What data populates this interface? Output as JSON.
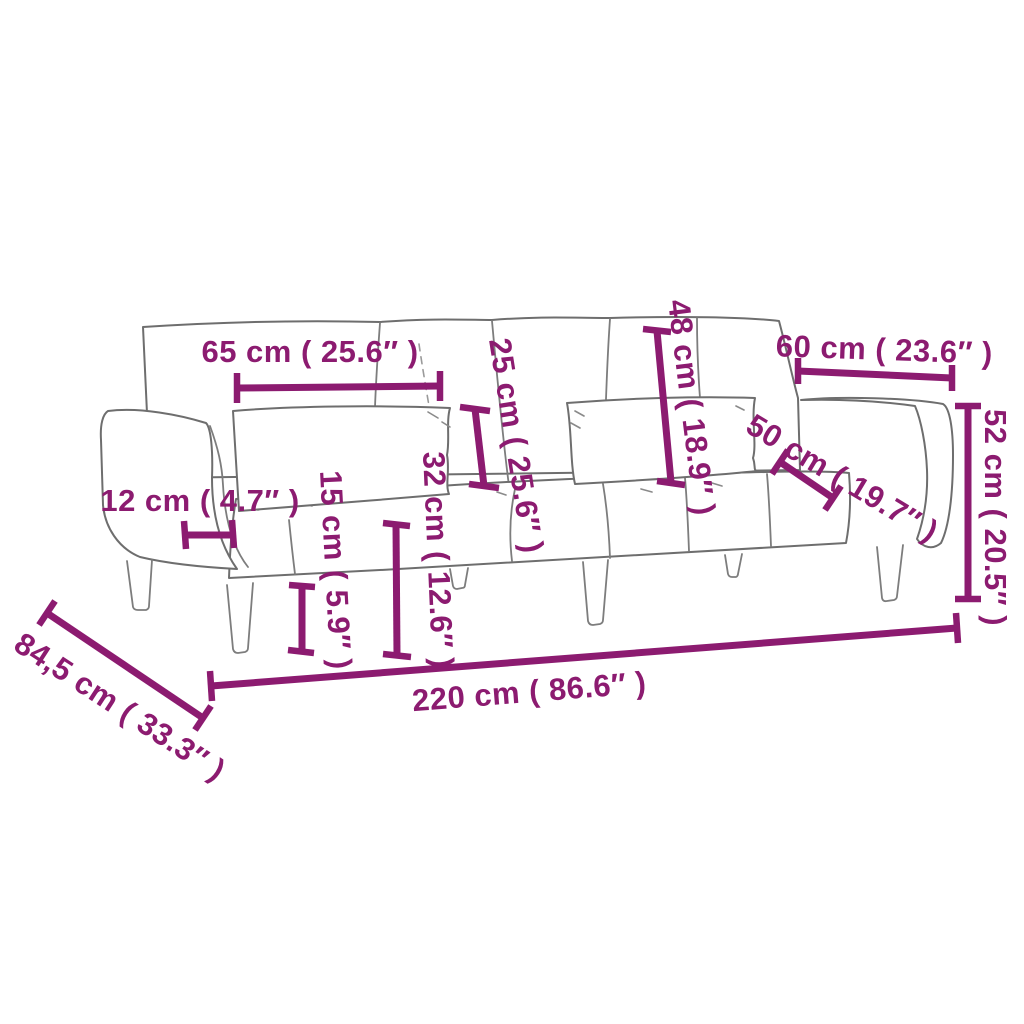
{
  "page": {
    "background_color": "#ffffff",
    "accent_color": "#8c1b70",
    "sofa_line_color": "#6e6e6e"
  },
  "diagram": {
    "subject": "sofa bed with two armrests, two lumbar pillows and tapered legs, line-art dimension drawing"
  },
  "measurements": {
    "backrest_section_width": "65 cm ( 25.6″ )",
    "pillow_thickness": "25 cm ( 25.6″ )",
    "backrest_height": "48 cm ( 18.9″ )",
    "armrest_length": "60 cm ( 23.6″ )",
    "seat_depth": "50 cm ( 19.7″ )",
    "armrest_height": "52 cm ( 20.5″ )",
    "armrest_width": "12 cm ( 4.7″ )",
    "leg_height": "15 cm ( 5.9″ )",
    "seat_height": "32 cm ( 12.6″ )",
    "overall_width": "220 cm ( 86.6″ )",
    "overall_depth": "84,5 cm ( 33.3″ )"
  }
}
